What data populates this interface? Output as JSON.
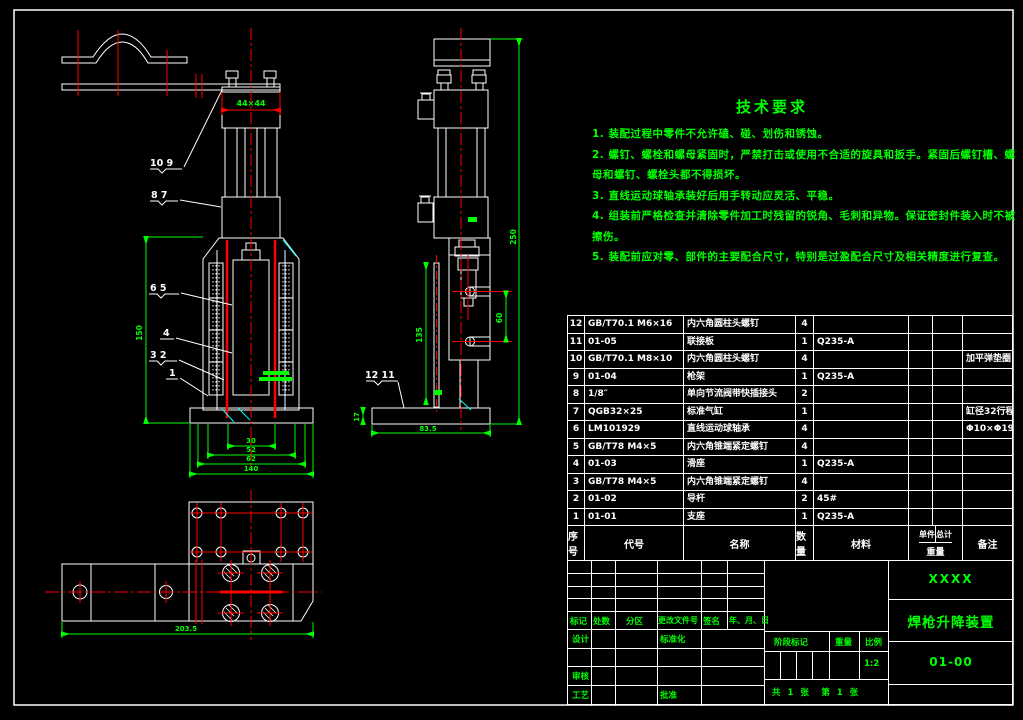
{
  "colors": {
    "accent_green": "#00ff00",
    "line_white": "#ffffff",
    "centerline_red": "#ff0000",
    "chamfer_cyan": "#00ffff",
    "background": "#000000"
  },
  "tech": {
    "title": "技术要求",
    "items": [
      "1. 装配过程中零件不允许磕、碰、划伤和锈蚀。",
      "2. 螺钉、螺栓和螺母紧固时，严禁打击或使用不合适的旋具和扳手。紧固后螺钉槽、螺母和螺钉、螺栓头都不得损坏。",
      "3. 直线运动球轴承装好后用手转动应灵活、平稳。",
      "4. 组装前严格检查并清除零件加工时残留的锐角、毛刺和异物。保证密封件装入时不被擦伤。",
      "5. 装配前应对零、部件的主要配合尺寸，特别是过盈配合尺寸及相关精度进行复查。"
    ]
  },
  "bom": {
    "headers": {
      "seq": "序号",
      "code": "代号",
      "name": "名称",
      "qty": "数量",
      "material": "材料",
      "unit": "单件",
      "total": "总计",
      "weight": "重量",
      "remark": "备注"
    },
    "rows": [
      {
        "no": "12",
        "code": "GB/T70.1 M6×16",
        "name": "内六角圆柱头螺钉",
        "qty": "4",
        "material": "",
        "remark": ""
      },
      {
        "no": "11",
        "code": "01-05",
        "name": "联接板",
        "qty": "1",
        "material": "Q235-A",
        "remark": ""
      },
      {
        "no": "10",
        "code": "GB/T70.1 M8×10",
        "name": "内六角圆柱头螺钉",
        "qty": "4",
        "material": "",
        "remark": "加平弹垫圈"
      },
      {
        "no": "9",
        "code": "01-04",
        "name": "枪架",
        "qty": "1",
        "material": "Q235-A",
        "remark": ""
      },
      {
        "no": "8",
        "code": "1/8″",
        "name": "单向节流阀带快插接头",
        "qty": "2",
        "material": "",
        "remark": ""
      },
      {
        "no": "7",
        "code": "QGB32×25",
        "name": "标准气缸",
        "qty": "1",
        "material": "",
        "remark": "缸径32行程25"
      },
      {
        "no": "6",
        "code": "LM101929",
        "name": "直线运动球轴承",
        "qty": "4",
        "material": "",
        "remark": "Φ10×Φ19×29"
      },
      {
        "no": "5",
        "code": "GB/T78 M4×5",
        "name": "内六角锥端紧定螺钉",
        "qty": "4",
        "material": "",
        "remark": ""
      },
      {
        "no": "4",
        "code": "01-03",
        "name": "滑座",
        "qty": "1",
        "material": "Q235-A",
        "remark": ""
      },
      {
        "no": "3",
        "code": "GB/T78 M4×5",
        "name": "内六角锥端紧定螺钉",
        "qty": "4",
        "material": "",
        "remark": ""
      },
      {
        "no": "2",
        "code": "01-02",
        "name": "导杆",
        "qty": "2",
        "material": "45#",
        "remark": ""
      },
      {
        "no": "1",
        "code": "01-01",
        "name": "支座",
        "qty": "1",
        "material": "Q235-A",
        "remark": ""
      }
    ]
  },
  "title_block": {
    "company": "XXXX",
    "drawing_title": "焊枪升降装置",
    "drawing_no": "01-00",
    "stage_label": "阶段标记",
    "weight_label": "重量",
    "scale_label": "比例",
    "scale": "1:2",
    "sheet_info": "共 1 张　第 1 张",
    "rev_labels": {
      "mark": "标记",
      "count": "处数",
      "zone": "分区",
      "doc_no": "更改文件号",
      "sign": "签名",
      "date": "年、月、日"
    },
    "role_labels": {
      "design": "设计",
      "standard": "标准化",
      "check": "审核",
      "process": "工艺",
      "approve": "批准"
    }
  },
  "views": {
    "balloons": [
      "10 9",
      "8 7",
      "6 5",
      "4",
      "3 2",
      "1",
      "12 11"
    ],
    "dims": {
      "front_top": "44×44",
      "front_height": "150",
      "front_base": [
        "30",
        "52",
        "62",
        "140"
      ],
      "side_height": "250",
      "side_pitch": "60",
      "side_guide": "135",
      "side_base_h": "17",
      "side_base_w": "83.5",
      "bottom_width": "203.5"
    }
  }
}
